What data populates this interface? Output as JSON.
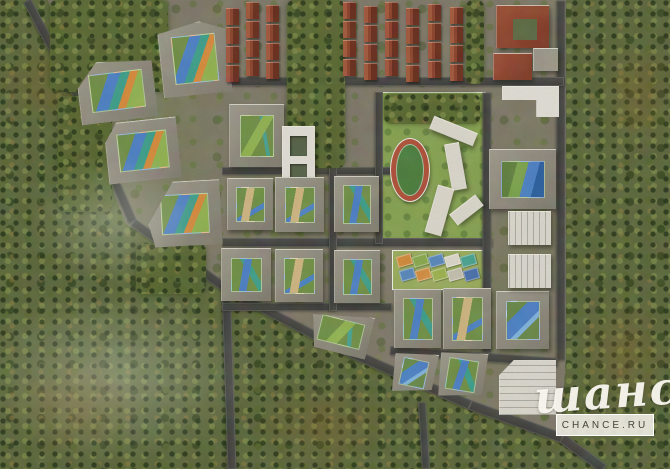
{
  "watermark": {
    "script_text": "шанс",
    "box_text": "CHANCE.RU"
  },
  "scene": {
    "canvas": {
      "width": 670,
      "height": 469
    },
    "palette": {
      "forest_base": "#5c673c",
      "parcel_ground": "#7d7767",
      "road": "#454543",
      "building_wall": "#8f8b7d",
      "building_light": "#dedbd2",
      "red_roof": "#8e4530",
      "court_green": "#6f8e46",
      "playground_blue": "#4d7fc1",
      "playground_teal": "#3f9d89",
      "playground_orange": "#d3893c",
      "stadium_track": "#ad4f38",
      "stadium_field": "#4c7c3e",
      "school_lawn": "#85a051"
    },
    "roads": [
      [
        27,
        0,
        78,
        96,
        9
      ],
      [
        78,
        96,
        133,
        222,
        9
      ],
      [
        133,
        222,
        232,
        292,
        9
      ],
      [
        232,
        292,
        340,
        348,
        9
      ],
      [
        340,
        348,
        470,
        405,
        10
      ],
      [
        470,
        405,
        562,
        438,
        10
      ],
      [
        562,
        438,
        604,
        469,
        10
      ],
      [
        226,
        284,
        232,
        469,
        9
      ],
      [
        422,
        402,
        426,
        469,
        8
      ],
      [
        561,
        0,
        561,
        360,
        9
      ],
      [
        225,
        81,
        564,
        81,
        9
      ],
      [
        222,
        171,
        392,
        171,
        8
      ],
      [
        222,
        242,
        492,
        242,
        9
      ],
      [
        222,
        307,
        392,
        307,
        8
      ],
      [
        390,
        350,
        558,
        362,
        9
      ],
      [
        333,
        92,
        333,
        311,
        8
      ],
      [
        379,
        92,
        379,
        244,
        8
      ],
      [
        487,
        92,
        487,
        352,
        9
      ]
    ],
    "zones": [
      {
        "cls": "lawn",
        "x": 382,
        "y": 92,
        "w": 102,
        "h": 152,
        "name": "school-grounds"
      },
      {
        "cls": "lawn2",
        "x": 392,
        "y": 250,
        "w": 90,
        "h": 38,
        "name": "playground-yard"
      }
    ],
    "trees": [
      {
        "x": 50,
        "y": 0,
        "w": 118,
        "h": 92
      },
      {
        "x": 58,
        "y": 96,
        "w": 54,
        "h": 116
      },
      {
        "x": 287,
        "y": 0,
        "w": 58,
        "h": 168
      },
      {
        "x": 136,
        "y": 244,
        "w": 70,
        "h": 50
      },
      {
        "x": 466,
        "y": 0,
        "w": 18,
        "h": 84
      },
      {
        "x": 384,
        "y": 94,
        "w": 96,
        "h": 30
      }
    ],
    "tints": [
      {
        "x": 70,
        "y": 15,
        "w": 170,
        "h": 250
      },
      {
        "x": 215,
        "y": 95,
        "w": 130,
        "h": 215
      },
      {
        "x": 388,
        "y": 246,
        "w": 170,
        "h": 160
      },
      {
        "x": 484,
        "y": 92,
        "w": 84,
        "h": 255
      }
    ],
    "autumn": [
      {
        "x": -10,
        "y": 40,
        "w": 130,
        "h": 90
      },
      {
        "x": 0,
        "y": 350,
        "w": 150,
        "h": 110
      },
      {
        "x": 595,
        "y": 30,
        "w": 85,
        "h": 130
      },
      {
        "x": 575,
        "y": 290,
        "w": 100,
        "h": 130
      },
      {
        "x": 250,
        "y": 380,
        "w": 150,
        "h": 90
      }
    ],
    "haze": [
      {
        "x": -40,
        "y": 280,
        "w": 310,
        "h": 190
      },
      {
        "x": 20,
        "y": 150,
        "w": 190,
        "h": 140
      }
    ],
    "stadium": {
      "x": 390,
      "y": 138,
      "w": 38,
      "h": 62
    },
    "playground_tiles": {
      "tw": 13,
      "th": 9,
      "rot": -16,
      "rows": [
        {
          "y": 255,
          "xs": [
            397,
            413,
            429,
            445,
            461
          ],
          "colors": [
            "#cf8a3e",
            "#88a84e",
            "#5b87b8",
            "#d9d5c6",
            "#4aa08e"
          ]
        },
        {
          "y": 269,
          "xs": [
            400,
            416,
            432,
            448,
            464
          ],
          "colors": [
            "#5b87b8",
            "#cf8a3e",
            "#9ab04e",
            "#c0bcab",
            "#4a6fa8"
          ]
        }
      ]
    },
    "townhouses": [
      {
        "x": 226,
        "y": 2,
        "cols": [
          0,
          20,
          40
        ],
        "dys": [
          6,
          0,
          3
        ],
        "units": 4,
        "uw": 13,
        "uh": 16,
        "gap": 3
      },
      {
        "x": 343,
        "y": 2,
        "cols": [
          0,
          21,
          42,
          63,
          85,
          107
        ],
        "dys": [
          0,
          4,
          0,
          6,
          2,
          5
        ],
        "units": 4,
        "uw": 13,
        "uh": 16,
        "gap": 3
      }
    ],
    "buildings": [
      {
        "kind": "court",
        "x": 160,
        "y": 22,
        "w": 68,
        "h": 72,
        "rot": -6,
        "clip": "polygon(0 12%,62% 0,100% 14%,100% 100%,0 100%)",
        "court": "colorful"
      },
      {
        "kind": "court",
        "x": 78,
        "y": 60,
        "w": 76,
        "h": 60,
        "rot": -7,
        "clip": "polygon(28% 0,100% 8%,100% 100%,0 100%,0 40%)",
        "court": "colorful"
      },
      {
        "kind": "court",
        "x": 106,
        "y": 120,
        "w": 72,
        "h": 60,
        "rot": -6,
        "clip": "polygon(18% 0,100% 0,100% 100%,0 100%,0 32%)",
        "court": "colorful"
      },
      {
        "kind": "court",
        "x": 148,
        "y": 181,
        "w": 72,
        "h": 64,
        "rot": -3,
        "clip": "polygon(36% 0,100% 0,100% 100%,8% 100%,0 64%)",
        "court": "colorful"
      },
      {
        "kind": "court",
        "x": 229,
        "y": 104,
        "w": 54,
        "h": 62,
        "rot": 0,
        "court": "green"
      },
      {
        "kind": "kinder",
        "x": 282,
        "y": 126,
        "w": 32,
        "h": 64,
        "rot": 0
      },
      {
        "kind": "court",
        "x": 227,
        "y": 178,
        "w": 45,
        "h": 51,
        "rot": 0,
        "court": "sand"
      },
      {
        "kind": "court",
        "x": 275,
        "y": 177,
        "w": 48,
        "h": 54,
        "rot": 0,
        "court": "sand"
      },
      {
        "kind": "court",
        "x": 334,
        "y": 176,
        "w": 44,
        "h": 55,
        "rot": 0,
        "court": "bluegreen"
      },
      {
        "kind": "court",
        "x": 221,
        "y": 248,
        "w": 49,
        "h": 52,
        "rot": 0,
        "court": "bluegreen"
      },
      {
        "kind": "court",
        "x": 275,
        "y": 249,
        "w": 47,
        "h": 52,
        "rot": 0,
        "court": "sand"
      },
      {
        "kind": "court",
        "x": 334,
        "y": 250,
        "w": 45,
        "h": 52,
        "rot": 0,
        "court": "bluegreen"
      },
      {
        "kind": "court",
        "x": 310,
        "y": 310,
        "w": 60,
        "h": 42,
        "rot": 14,
        "clip": "polygon(0 26%,100% 0,100% 100%,14% 100%)",
        "court": "green"
      },
      {
        "kind": "court",
        "x": 394,
        "y": 289,
        "w": 46,
        "h": 58,
        "rot": 0,
        "court": "bluegreen"
      },
      {
        "kind": "court",
        "x": 443,
        "y": 288,
        "w": 47,
        "h": 60,
        "rot": 0,
        "court": "sand"
      },
      {
        "kind": "court",
        "x": 496,
        "y": 291,
        "w": 52,
        "h": 57,
        "rot": 0,
        "court": "blue"
      },
      {
        "kind": "court",
        "x": 489,
        "y": 149,
        "w": 66,
        "h": 59,
        "rot": 0,
        "court": "colorful2"
      },
      {
        "kind": "court",
        "x": 392,
        "y": 350,
        "w": 42,
        "h": 44,
        "rot": 12,
        "clip": "polygon(0 16%,100% 0,100% 80%,10% 100%)",
        "court": "blue"
      },
      {
        "kind": "court",
        "x": 438,
        "y": 350,
        "w": 46,
        "h": 48,
        "rot": 9,
        "clip": "polygon(0 12%,100% 0,100% 84%,8% 100%)",
        "court": "bluegreen"
      },
      {
        "kind": "red",
        "x": 496,
        "y": 5,
        "w": 52,
        "h": 42,
        "rot": 0,
        "notch": true
      },
      {
        "kind": "red",
        "x": 493,
        "y": 53,
        "w": 38,
        "h": 26,
        "rot": 0
      },
      {
        "kind": "slab",
        "x": 533,
        "y": 48,
        "w": 24,
        "h": 22,
        "rot": 0,
        "color": "#9a9589",
        "name": "office-building"
      },
      {
        "kind": "slab",
        "x": 502,
        "y": 86,
        "w": 56,
        "h": 30,
        "rot": 0,
        "clip": "polygon(0 0,100% 0,100% 100%,60% 100%,60% 45%,0 45%)",
        "name": "retail-building"
      },
      {
        "kind": "garage",
        "x": 508,
        "y": 211,
        "w": 42,
        "h": 33
      },
      {
        "kind": "garage",
        "x": 508,
        "y": 254,
        "w": 42,
        "h": 33
      },
      {
        "kind": "garage",
        "x": 499,
        "y": 360,
        "w": 56,
        "h": 54,
        "clip": "polygon(0 28%,26% 0,100% 0,100% 100%,0 100%)",
        "big": true
      },
      {
        "kind": "slab",
        "x": 430,
        "y": 124,
        "w": 46,
        "h": 13,
        "rot": 22,
        "color": "#d8d4c8",
        "name": "school-building-wing"
      },
      {
        "kind": "slab",
        "x": 448,
        "y": 143,
        "w": 14,
        "h": 46,
        "rot": -10,
        "color": "#d8d4c8",
        "name": "school-building-wing"
      },
      {
        "kind": "slab",
        "x": 431,
        "y": 186,
        "w": 16,
        "h": 48,
        "rot": 16,
        "color": "#d8d4c8",
        "name": "school-building-wing"
      },
      {
        "kind": "slab",
        "x": 450,
        "y": 203,
        "w": 32,
        "h": 13,
        "rot": -38,
        "color": "#d8d4c8",
        "name": "school-building-wing"
      }
    ]
  }
}
